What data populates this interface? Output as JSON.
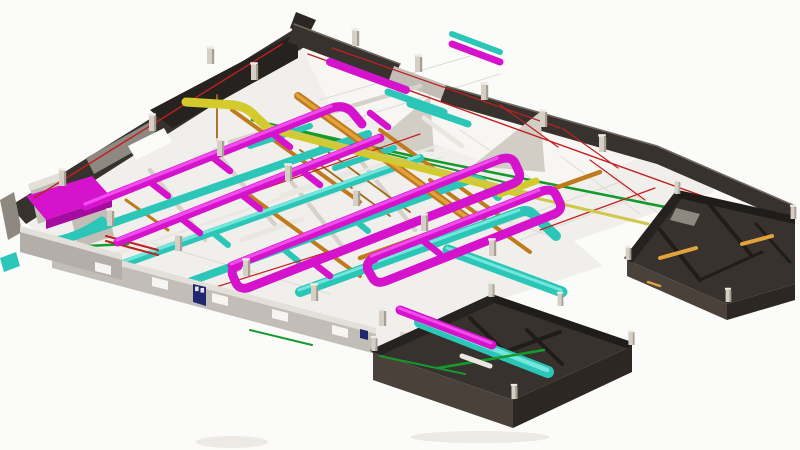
{
  "scene": {
    "type": "3d-bim-axonometric-view",
    "subject": "building-floor-mep-coordination-model"
  },
  "colors": {
    "background": "#fbfbfa",
    "floor": "#f1efeb",
    "floor_light": "#f7f6f3",
    "line_faint": "#dfdbd5",
    "shadow": "#edeae5",
    "walls": {
      "dark_top": "#37322d",
      "dark_face": "#26221f",
      "dark_deep": "#201c19",
      "dark_brown": "#4a423a",
      "dark_side": "#2c2723",
      "edge_light": "#6e675f",
      "gray_face": "#c2beb7",
      "gray_top": "#e3e0d9",
      "gray_mid": "#8e8880",
      "parapet": "#b3afa8",
      "partition": "#d6d2ca",
      "panel": "#d2cec6",
      "window": "#f6f5f2"
    },
    "systems": {
      "magenta": "#d513cc",
      "magenta_hl": "#f14cee",
      "magenta_dark": "#a30c9e",
      "cyan": "#2cc6b8",
      "cyan_hl": "#74e6db",
      "orange": "#c07a1e",
      "orange_hl": "#e2a33c",
      "copper": "#a36a1b",
      "yellow": "#d3ca2c",
      "yellow_stub": "#cfc84a",
      "green": "#159a2e",
      "red": "#c12020",
      "white_duct": "#e9e7e2"
    },
    "door_navy": "#20276f",
    "door_pane": "#dfe3f0",
    "column": {
      "face": "#d5cfc5",
      "side": "#a89f92",
      "top": "#efece6"
    }
  }
}
